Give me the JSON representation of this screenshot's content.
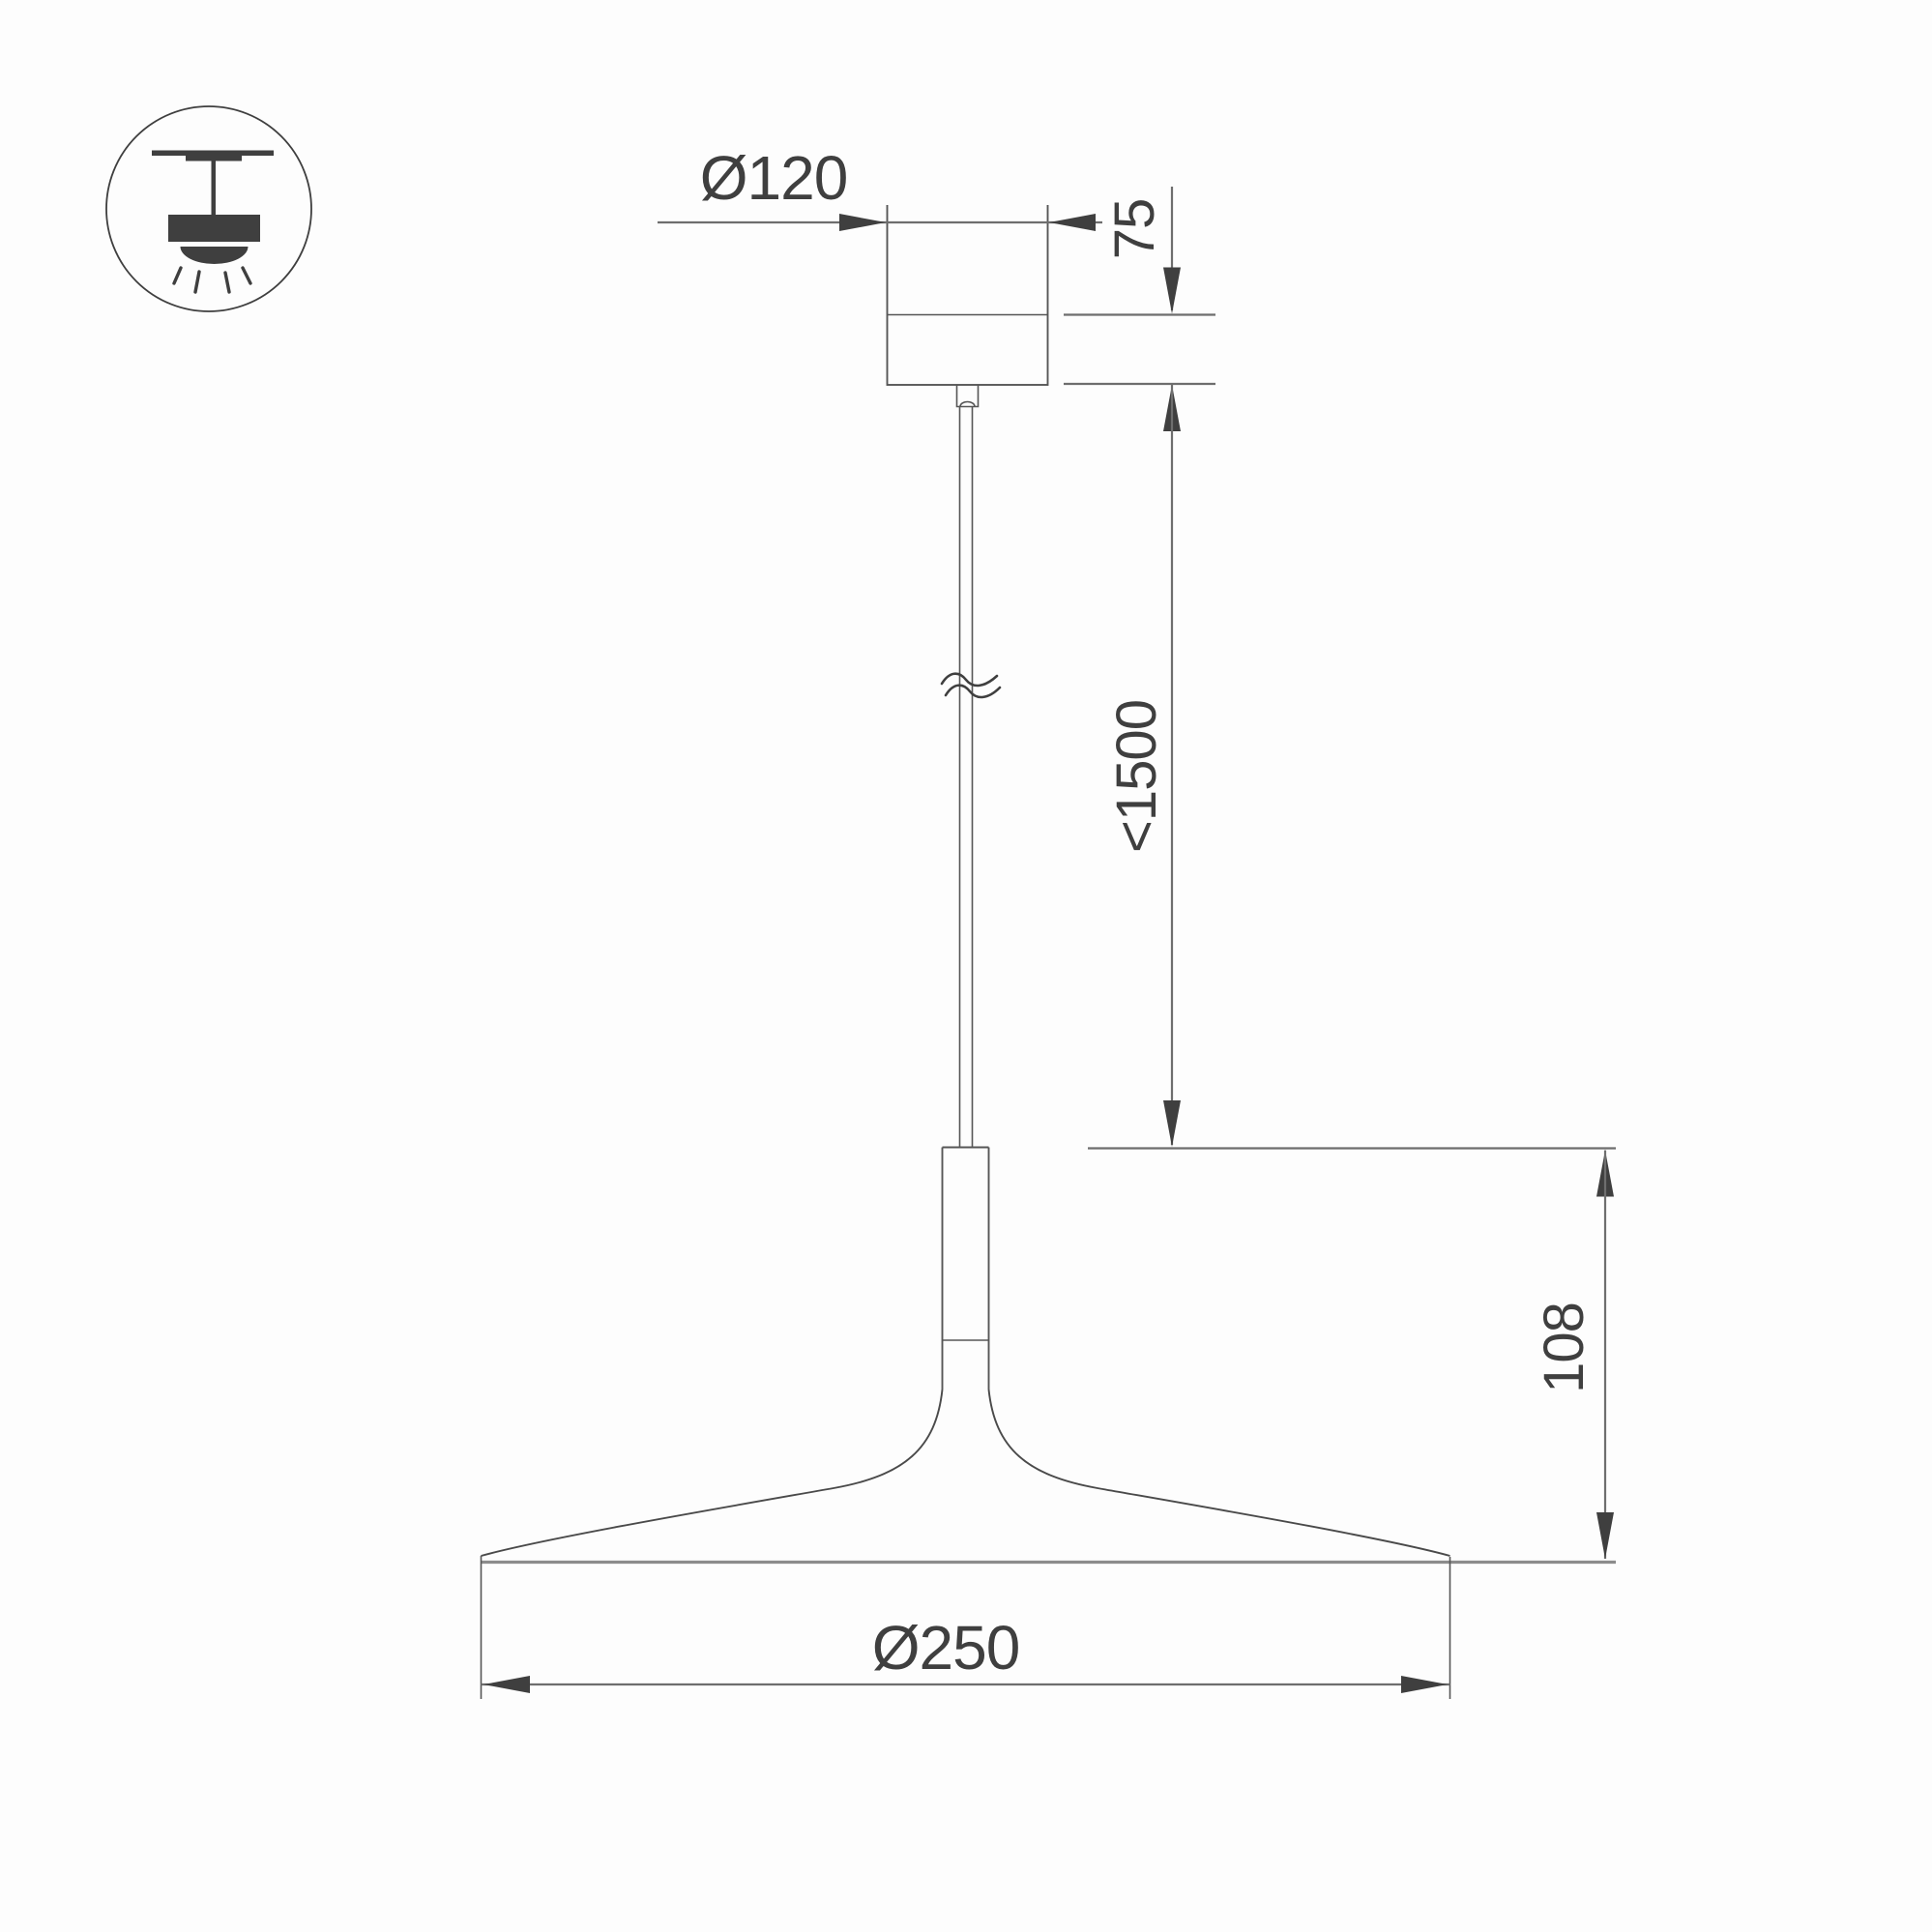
{
  "title": "Pendant luminaire dimensional drawing",
  "labels": {
    "canopy_diameter": "Ø120",
    "canopy_height": "75",
    "suspension_max_length": "<1500",
    "shade_height": "108",
    "shade_diameter": "Ø250"
  },
  "icon": {
    "name": "pendant-ceiling-light",
    "description": "ceiling-mounted pendant lamp with downward light rays"
  },
  "colors": {
    "c-bg": "#fdfdfd",
    "c-text": "#3f3f3f",
    "c-dim": "#6e6e6e",
    "c-obj": "#565656",
    "c-shade": "#8c8c8c"
  }
}
